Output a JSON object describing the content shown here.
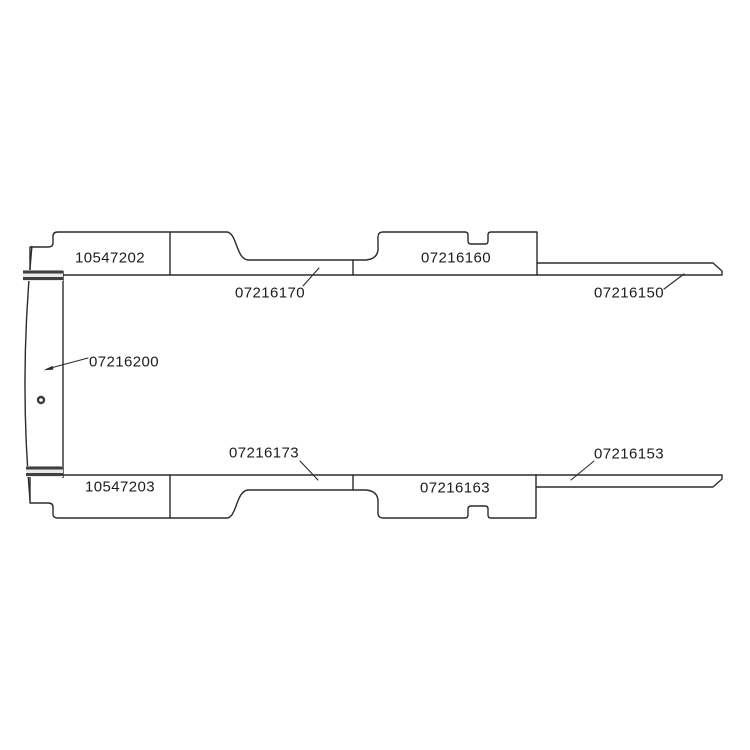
{
  "canvas": {
    "width": 750,
    "height": 750,
    "background": "#ffffff"
  },
  "diagram": {
    "type": "technical-parts-drawing",
    "colors": {
      "line": "#2b2b2b",
      "leader": "#2b2b2b",
      "seal_dark": "#404040",
      "seal_light": "#e9e9e9",
      "text": "#1c1c1c"
    },
    "icons": [
      {
        "name": "fastener-icon",
        "shape": "small-ring"
      }
    ],
    "labels": [
      {
        "part_number": "10547202",
        "region": "top-left-panel",
        "callout": "none"
      },
      {
        "part_number": "07216170",
        "region": "top-center-panel",
        "callout": "leader-line"
      },
      {
        "part_number": "07216160",
        "region": "top-right-panel",
        "callout": "none"
      },
      {
        "part_number": "07216150",
        "region": "top-edge-strip",
        "callout": "leader-line"
      },
      {
        "part_number": "07216200",
        "region": "left-end-panel",
        "callout": "leader-arrow"
      },
      {
        "part_number": "07216173",
        "region": "bottom-center-panel",
        "callout": "leader-line"
      },
      {
        "part_number": "07216163",
        "region": "bottom-right-panel",
        "callout": "none"
      },
      {
        "part_number": "07216153",
        "region": "bottom-edge-strip",
        "callout": "leader-line"
      },
      {
        "part_number": "10547203",
        "region": "bottom-left-panel",
        "callout": "none"
      }
    ]
  }
}
